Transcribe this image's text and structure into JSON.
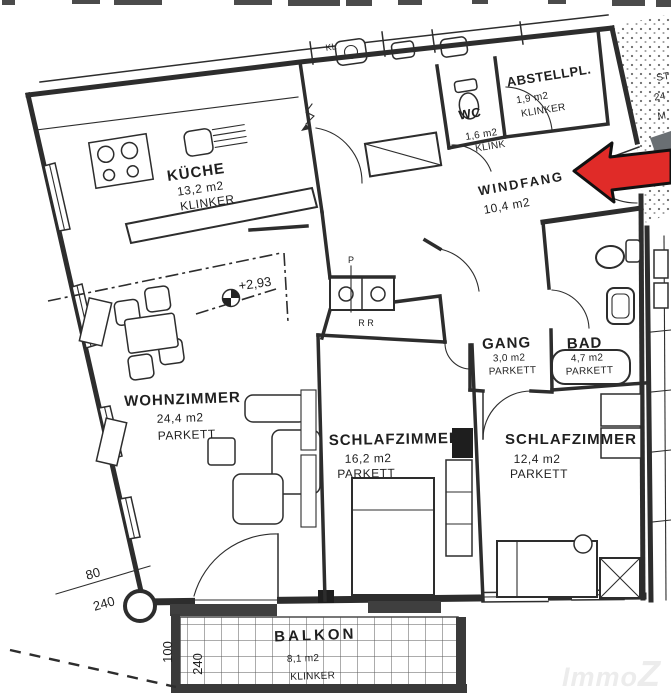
{
  "rooms": {
    "kueche": {
      "name": "KÜCHE",
      "area": "13,2 m2",
      "floor": "KLINKER"
    },
    "abstellplatz": {
      "name": "ABSTELLPL.",
      "area": "1,9 m2",
      "floor": "KLINKER"
    },
    "wc": {
      "name": "WC",
      "area": "1,6 m2",
      "floor": "KLINK"
    },
    "windfang": {
      "name": "WINDFANG",
      "area": "10,4 m2"
    },
    "gang": {
      "name": "GANG",
      "area": "3,0 m2",
      "floor": "PARKETT"
    },
    "bad": {
      "name": "BAD",
      "area": "4,7 m2",
      "floor": "PARKETT"
    },
    "wohnzimmer": {
      "name": "WOHNZIMMER",
      "area": "24,4 m2",
      "floor": "PARKETT"
    },
    "schlafzimmer_1": {
      "name": "SCHLAFZIMMER",
      "area": "16,2 m2",
      "floor": "PARKETT"
    },
    "schlafzimmer_2": {
      "name": "SCHLAFZIMMER",
      "area": "12,4 m2",
      "floor": "PARKETT"
    },
    "balkon": {
      "name": "BALKON",
      "area": "8,1 m2",
      "floor": "KLINKER"
    }
  },
  "annotations": {
    "level": "+2,93",
    "shaft_p": "P",
    "shaft_rr": "R R",
    "door_dim_top": "80",
    "door_dim_bottom": "240",
    "balcony_dim_width": "100",
    "balcony_dim_depth": "240",
    "neighbor_kl": "KL",
    "stair_st": "ST",
    "stair_24": "24",
    "stair_m": "M"
  },
  "watermark": {
    "immo": "Immo",
    "z": "Z"
  },
  "colors": {
    "arrow_red": "#e02b28",
    "arrow_gray": "#6a6f73",
    "line": "#2d2d2d",
    "watermark": "#ececec"
  }
}
